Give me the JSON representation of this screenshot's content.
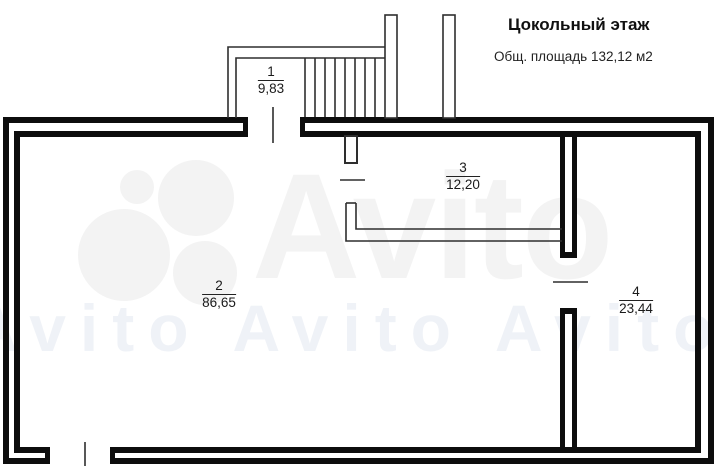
{
  "header": {
    "title": "Цокольный этаж",
    "subtitle": "Общ. площадь 132,12 м2"
  },
  "watermark": {
    "brand": "Avito",
    "tile_text": "Avito Avito Avito Avito Avito"
  },
  "rooms": [
    {
      "number": "1",
      "area": "9,83"
    },
    {
      "number": "2",
      "area": "86,65"
    },
    {
      "number": "3",
      "area": "12,20"
    },
    {
      "number": "4",
      "area": "23,44"
    }
  ],
  "colors": {
    "wall": "#0d0d0d",
    "thin_line": "#2e2e2e",
    "text": "#1a1a1a",
    "watermark": "#f3f3f3",
    "background": "#ffffff"
  }
}
